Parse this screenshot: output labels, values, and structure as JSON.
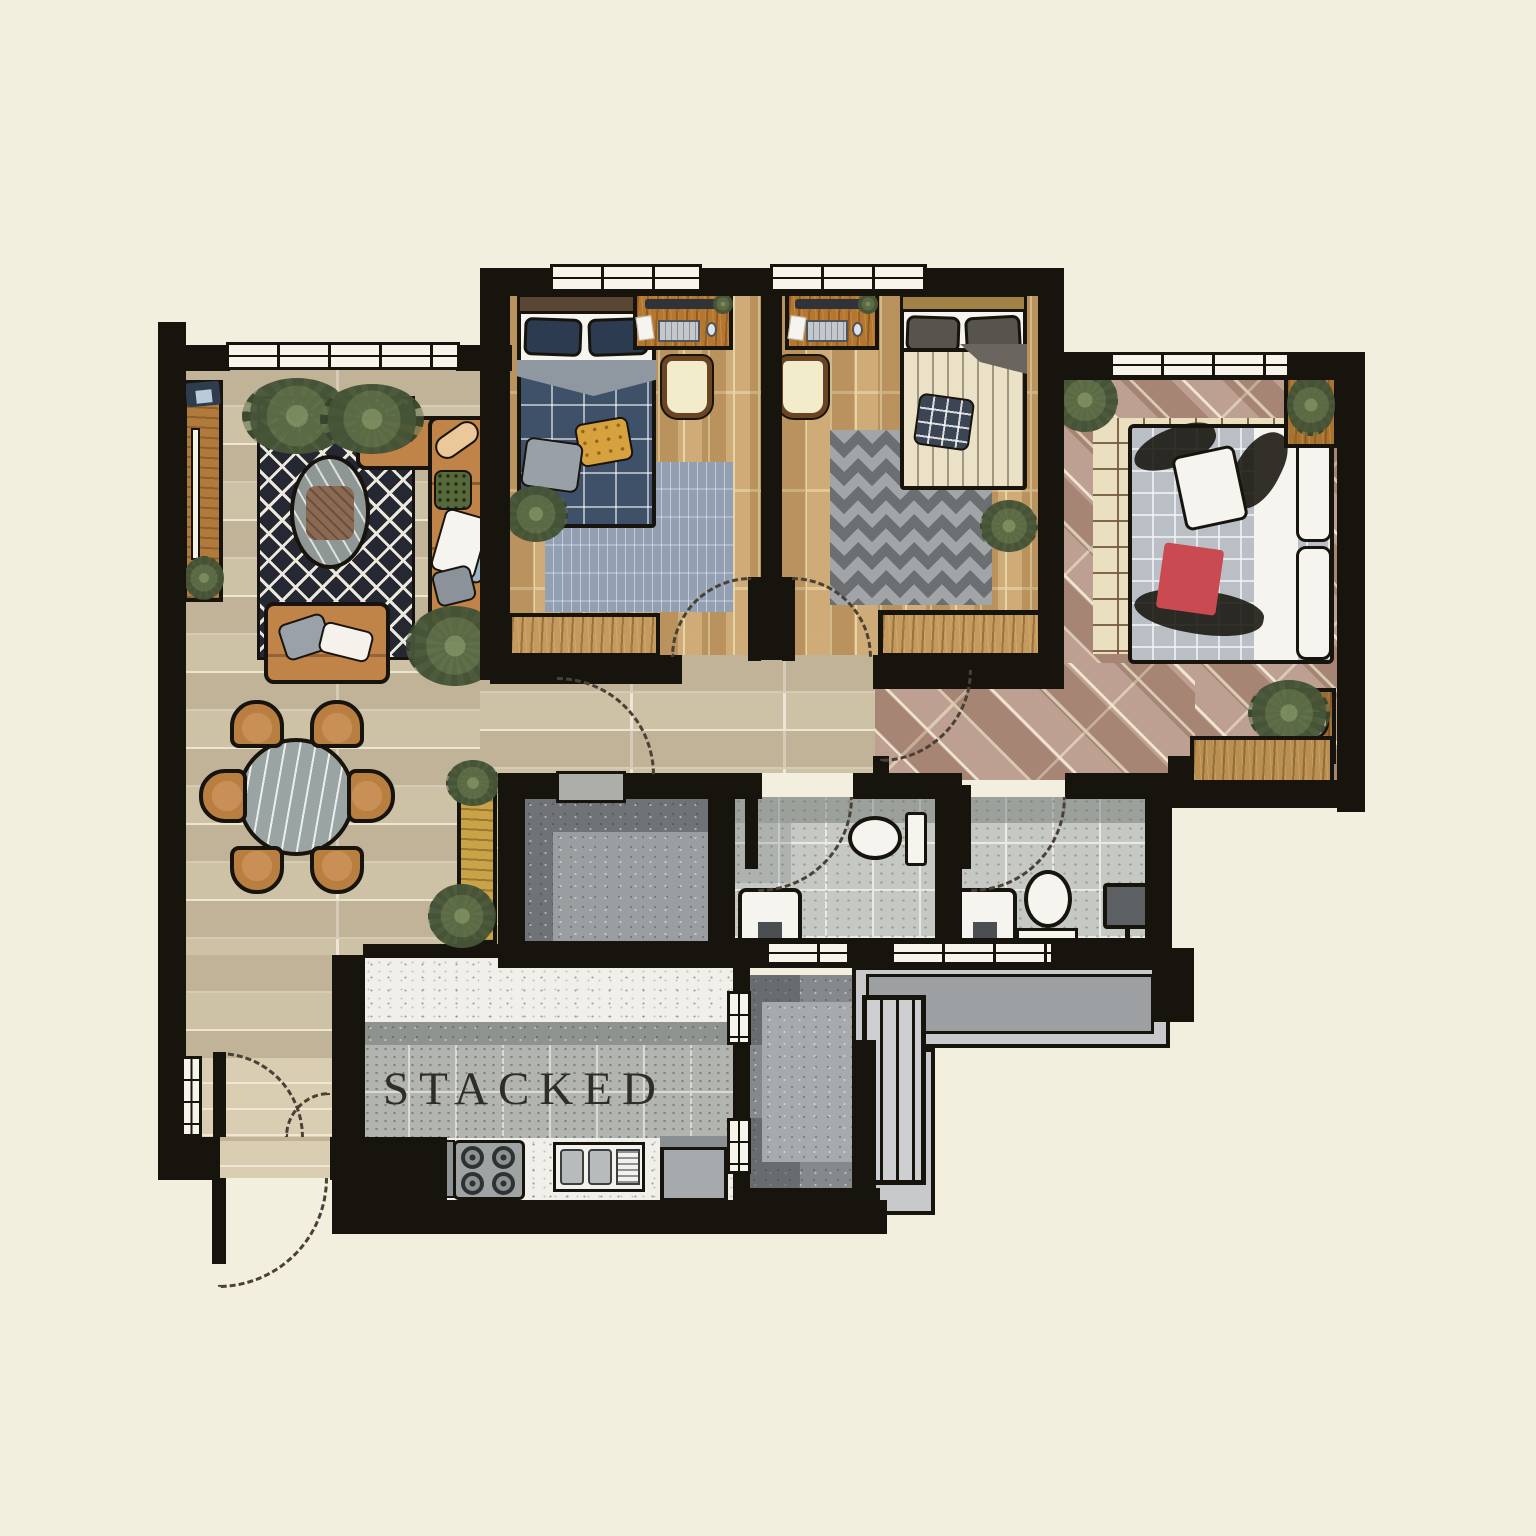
{
  "plan": {
    "label": "STACKED",
    "palette": {
      "background": "#f2efde",
      "wall": "#17140e",
      "wood": "#b5762f",
      "living_floor": "#cdc1a6",
      "bedroom_floor": "#c7a06a",
      "master_floor": "#b39180",
      "bath_tile": "#c6c8c4",
      "kitchen_tile": "#b2b4b0",
      "counter": "#f0efe9",
      "rug_dark": "#252832",
      "sofa": "#c08348",
      "accent_red": "#c94a50",
      "plant_green": "#566446"
    },
    "rooms": [
      {
        "name": "living-dining",
        "furniture": [
          "sectional-sofa",
          "loveseat",
          "oval-coffee-table",
          "diamond-rug",
          "tv-console",
          "round-dining-table",
          "six-dining-chairs",
          "plants"
        ]
      },
      {
        "name": "bedroom-1",
        "furniture": [
          "double-bed",
          "desk",
          "desk-chair",
          "blue-rug",
          "wardrobe",
          "plant"
        ]
      },
      {
        "name": "bedroom-2",
        "furniture": [
          "double-bed",
          "desk",
          "desk-chair",
          "chevron-rug",
          "wardrobe",
          "plant"
        ]
      },
      {
        "name": "master-bedroom",
        "furniture": [
          "king-bed",
          "check-rug",
          "wardrobe",
          "side-table",
          "planter",
          "plants"
        ]
      },
      {
        "name": "bathroom-1",
        "furniture": [
          "toilet",
          "basin"
        ]
      },
      {
        "name": "bathroom-2",
        "furniture": [
          "toilet",
          "basin",
          "wall-cabinet"
        ]
      },
      {
        "name": "household-shelter",
        "furniture": []
      },
      {
        "name": "kitchen",
        "furniture": [
          "counter",
          "gas-stove",
          "double-sink",
          "refrigerator"
        ]
      },
      {
        "name": "service-ledge",
        "furniture": [
          "ac-ledge",
          "drying-rack"
        ]
      },
      {
        "name": "entrance",
        "furniture": [
          "console",
          "plants",
          "double-door"
        ]
      }
    ]
  }
}
